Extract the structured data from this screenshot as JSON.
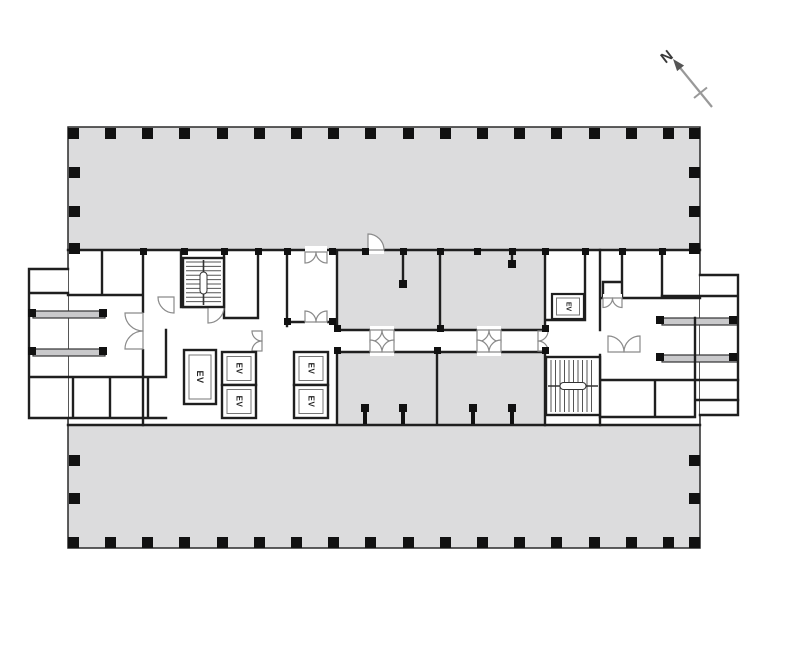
{
  "north_indicator": {
    "label": "N"
  },
  "floor_plan": {
    "elevators": [
      {
        "label": "EV"
      },
      {
        "label": "EV"
      },
      {
        "label": "EV"
      },
      {
        "label": "EV"
      },
      {
        "label": "EV"
      },
      {
        "label": "EV"
      }
    ],
    "colors": {
      "slab_fill": "#dcdcdd",
      "wall": "#1f1f1f",
      "door_line": "#8a8a8a",
      "column": "#111111"
    }
  }
}
